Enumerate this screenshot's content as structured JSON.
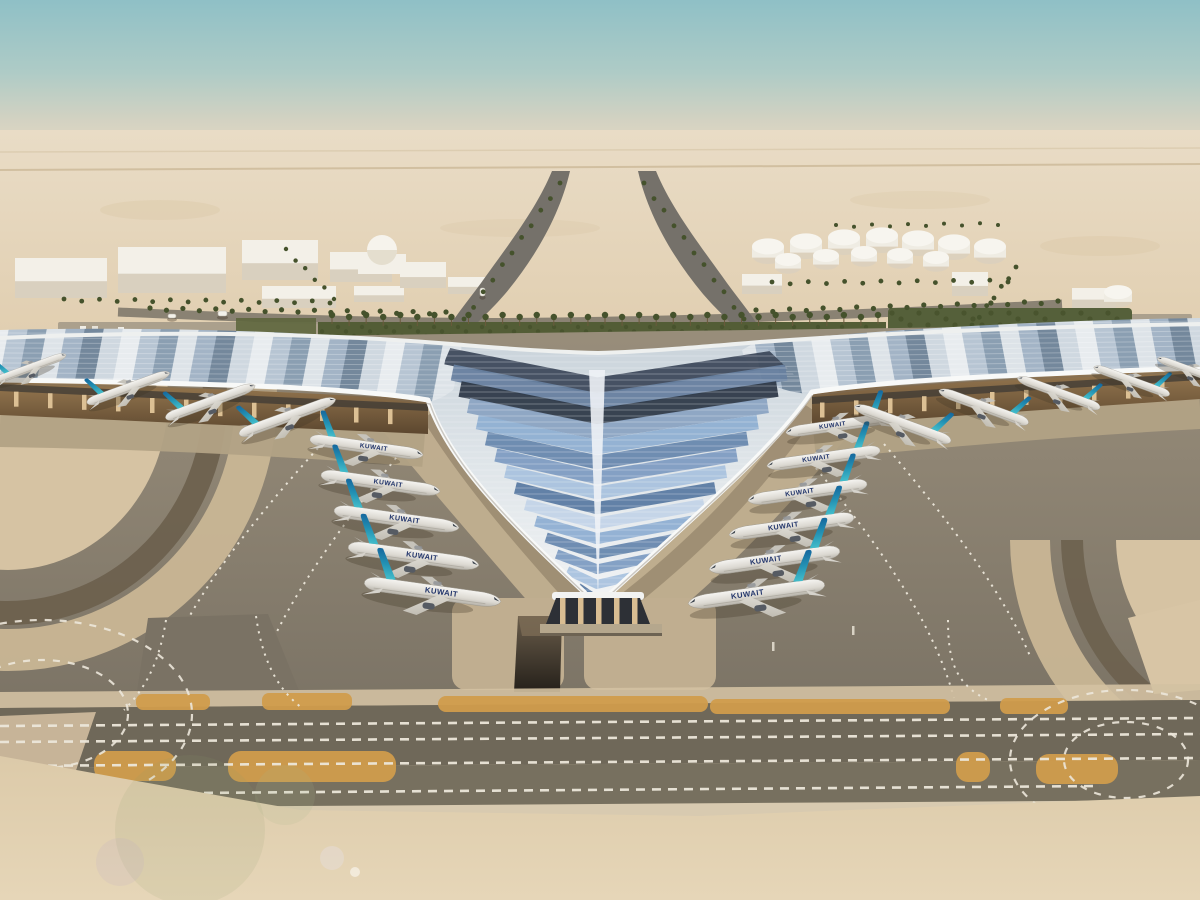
{
  "scene": {
    "title": "Aerial rendering of a desert airport: trefoil terminal with swooping white canopy, blue chevron roof glazing, and rows of parked KUWAIT airliners",
    "setting": "desert, hazy teal sky"
  },
  "palette": {
    "sky_top": "#8fc0c6",
    "sky_mid": "#aecbc6",
    "horizon_haze": "#e8dbc4",
    "desert": "#e4d3b8",
    "building_white": "#f3f0e8",
    "building_shade": "#d9d0bf",
    "tank_white": "#efece3",
    "road_gray": "#857d70",
    "palm_green": "#45522c",
    "landscape_green": "#535d36",
    "roof_white": "#f1f3f4",
    "under_canopy": "#9a7b52",
    "under_canopy_dark": "#5c472f",
    "column_tan": "#dcc094",
    "apron_gray": "#8a8070",
    "concrete_light": "#c0ae90",
    "ring_sand": "#d6c3a3",
    "ring_dark": "#6b5f4c",
    "ring_tan": "#c9b695",
    "taxiway_dark": "#6f6859",
    "marking_white": "#ece7da",
    "marking_orange": "#d09c4c",
    "fuselage_white": "#efede7",
    "tail_teal": "#45c0cc",
    "tail_mid": "#2391b3",
    "tail_blue": "#14649c",
    "titles_navy": "#22356b",
    "sand_fore": "#dccaa9",
    "glass_dark": "#2d3036"
  },
  "roof": {
    "stripe_colors": [
      "#e8ecef",
      "#b7c5d3",
      "#8b9fb2",
      "#dde3e8",
      "#a3b4c6",
      "#74889c",
      "#cfd8e0"
    ],
    "chevron_colors": [
      "#7e9cc2",
      "#a9c2de",
      "#5b7ba3",
      "#c3d4e8",
      "#8fafd2",
      "#6888ae"
    ],
    "chevron_dark_colors": [
      "#3e4a5c",
      "#67809f",
      "#2f3a49",
      "#8ba3c2"
    ]
  },
  "aircraft": {
    "airline_label": "KUWAIT",
    "groups": [
      {
        "name": "left-inner-row",
        "dir": 1,
        "rot": 8,
        "label": true,
        "planes": [
          [
            366,
            447,
            0.78
          ],
          [
            380,
            483,
            0.82
          ],
          [
            396,
            519,
            0.86
          ],
          [
            413,
            556,
            0.9
          ],
          [
            432,
            592,
            0.94
          ]
        ]
      },
      {
        "name": "right-inner-row",
        "dir": -1,
        "rot": -8,
        "label": true,
        "planes": [
          [
            840,
            425,
            0.74
          ],
          [
            824,
            458,
            0.78
          ],
          [
            808,
            492,
            0.82
          ],
          [
            792,
            526,
            0.86
          ],
          [
            775,
            560,
            0.9
          ],
          [
            757,
            594,
            0.94
          ]
        ]
      },
      {
        "name": "left-wing-row",
        "dir": 1,
        "rot": -20,
        "label": false,
        "planes": [
          [
            30,
            368,
            0.52
          ],
          [
            128,
            388,
            0.6
          ],
          [
            210,
            402,
            0.65
          ],
          [
            287,
            417,
            0.7
          ]
        ]
      },
      {
        "name": "right-wing-row",
        "dir": -1,
        "rot": 20,
        "label": false,
        "planes": [
          [
            903,
            424,
            0.7
          ],
          [
            984,
            407,
            0.65
          ],
          [
            1059,
            393,
            0.6
          ],
          [
            1132,
            381,
            0.55
          ],
          [
            1192,
            371,
            0.5
          ]
        ]
      }
    ]
  },
  "background": {
    "buildings": [
      [
        15,
        258,
        92,
        40
      ],
      [
        118,
        247,
        108,
        46
      ],
      [
        242,
        240,
        76,
        40
      ],
      [
        262,
        286,
        74,
        22
      ],
      [
        330,
        252,
        62,
        30
      ],
      [
        354,
        286,
        50,
        16
      ],
      [
        400,
        262,
        46,
        26
      ],
      [
        448,
        277,
        38,
        17
      ],
      [
        742,
        274,
        40,
        20
      ],
      [
        952,
        272,
        36,
        24
      ],
      [
        1072,
        288,
        44,
        20
      ]
    ],
    "dome": {
      "x": 382,
      "y": 250,
      "r": 15
    },
    "fuel_tanks": [
      [
        768,
        252,
        16
      ],
      [
        806,
        247,
        16
      ],
      [
        844,
        243,
        16
      ],
      [
        882,
        241,
        16
      ],
      [
        918,
        244,
        16
      ],
      [
        954,
        248,
        16
      ],
      [
        990,
        252,
        16
      ],
      [
        788,
        264,
        13
      ],
      [
        826,
        260,
        13
      ],
      [
        864,
        257,
        13
      ],
      [
        900,
        259,
        13
      ],
      [
        936,
        262,
        13
      ],
      [
        1118,
        297,
        14
      ]
    ]
  },
  "landscape": {
    "palm_rows": [
      {
        "x1": 332,
        "y1": 316,
        "x2": 878,
        "y2": 316,
        "n": 33,
        "r": 3.2,
        "trunk": true
      },
      {
        "x1": 150,
        "y1": 309,
        "x2": 446,
        "y2": 313,
        "n": 19,
        "r": 2.6
      },
      {
        "x1": 756,
        "y1": 311,
        "x2": 1058,
        "y2": 302,
        "n": 19,
        "r": 2.6
      },
      {
        "x1": 560,
        "y1": 184,
        "x2": 464,
        "y2": 320,
        "n": 11,
        "r": 2.4
      },
      {
        "x1": 644,
        "y1": 184,
        "x2": 744,
        "y2": 320,
        "n": 11,
        "r": 2.4
      },
      {
        "x1": 64,
        "y1": 300,
        "x2": 330,
        "y2": 302,
        "n": 16,
        "r": 2.4
      },
      {
        "x1": 772,
        "y1": 283,
        "x2": 1008,
        "y2": 281,
        "n": 14,
        "r": 2.4
      },
      {
        "x1": 1016,
        "y1": 268,
        "x2": 972,
        "y2": 326,
        "n": 7,
        "r": 2.4
      },
      {
        "x1": 286,
        "y1": 250,
        "x2": 334,
        "y2": 298,
        "n": 6,
        "r": 2.2
      },
      {
        "x1": 836,
        "y1": 226,
        "x2": 998,
        "y2": 224,
        "n": 10,
        "r": 2.0
      }
    ]
  },
  "markings": {
    "orange_strips": [
      [
        136,
        694,
        74,
        16,
        7
      ],
      [
        262,
        693,
        90,
        17,
        7
      ],
      [
        438,
        696,
        270,
        16,
        8
      ],
      [
        710,
        699,
        240,
        15,
        7
      ],
      [
        1000,
        698,
        68,
        16,
        7
      ],
      [
        94,
        751,
        82,
        30,
        13
      ],
      [
        228,
        751,
        168,
        31,
        13
      ],
      [
        956,
        752,
        34,
        30,
        12
      ],
      [
        1036,
        754,
        82,
        30,
        13
      ]
    ]
  },
  "vehicles": [
    {
      "x": 794,
      "y": 618,
      "w": 16,
      "h": 9
    },
    {
      "x": 218,
      "y": 311,
      "w": 9,
      "h": 5
    },
    {
      "x": 168,
      "y": 314,
      "w": 8,
      "h": 4
    },
    {
      "x": 480,
      "y": 288,
      "w": 5,
      "h": 8
    }
  ]
}
